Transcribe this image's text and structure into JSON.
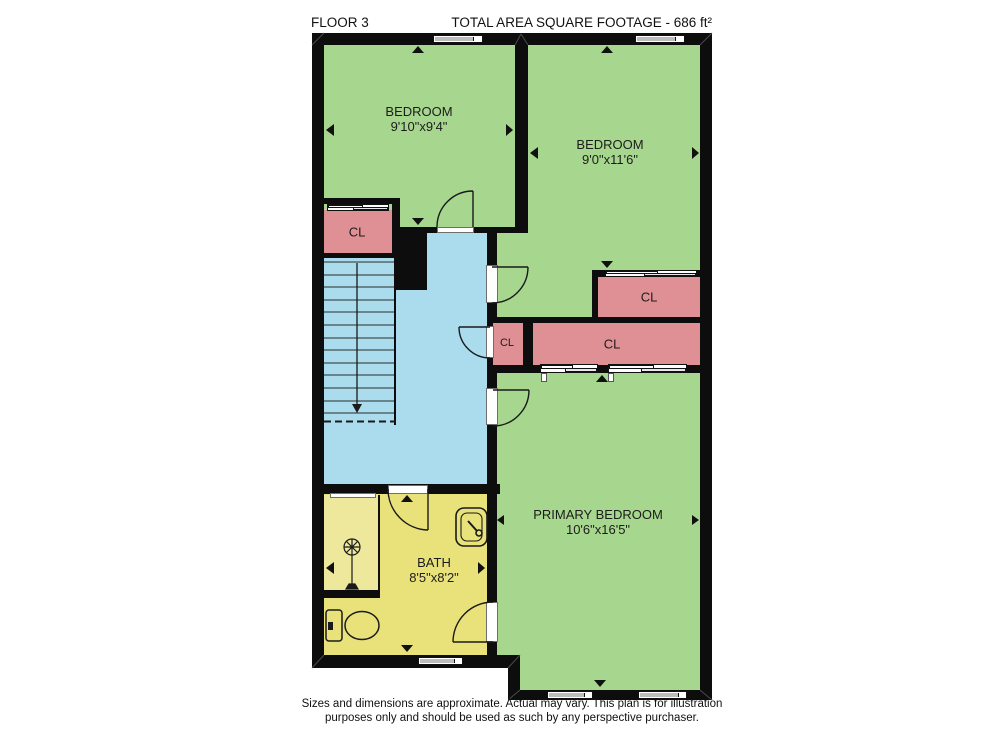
{
  "header": {
    "floor": "FLOOR 3",
    "total_area": "TOTAL AREA SQUARE FOOTAGE - 686 ft²"
  },
  "rooms": {
    "bedroom_top_left": {
      "name": "BEDROOM",
      "dims": "9'10\"x9'4\""
    },
    "bedroom_top_right": {
      "name": "BEDROOM",
      "dims": "9'0\"x11'6\""
    },
    "primary_bedroom": {
      "name": "PRIMARY BEDROOM",
      "dims": "10'6\"x16'5\""
    },
    "bath": {
      "name": "BATH",
      "dims": "8'5\"x8'2\""
    }
  },
  "closets": {
    "cl1": "CL",
    "cl2": "CL",
    "cl3": "CL",
    "cl4": "CL"
  },
  "footer": {
    "line1": "Sizes and dimensions are approximate. Actual may vary. This plan is for illustration",
    "line2": "purposes only and should be used as such by any perspective purchaser."
  },
  "colors": {
    "room_green": "#a7d78e",
    "closet_pink": "#df9094",
    "stairs_blue": "#aadcee",
    "bath_yellow": "#e9e27b",
    "wall": "#0d0d0d"
  }
}
